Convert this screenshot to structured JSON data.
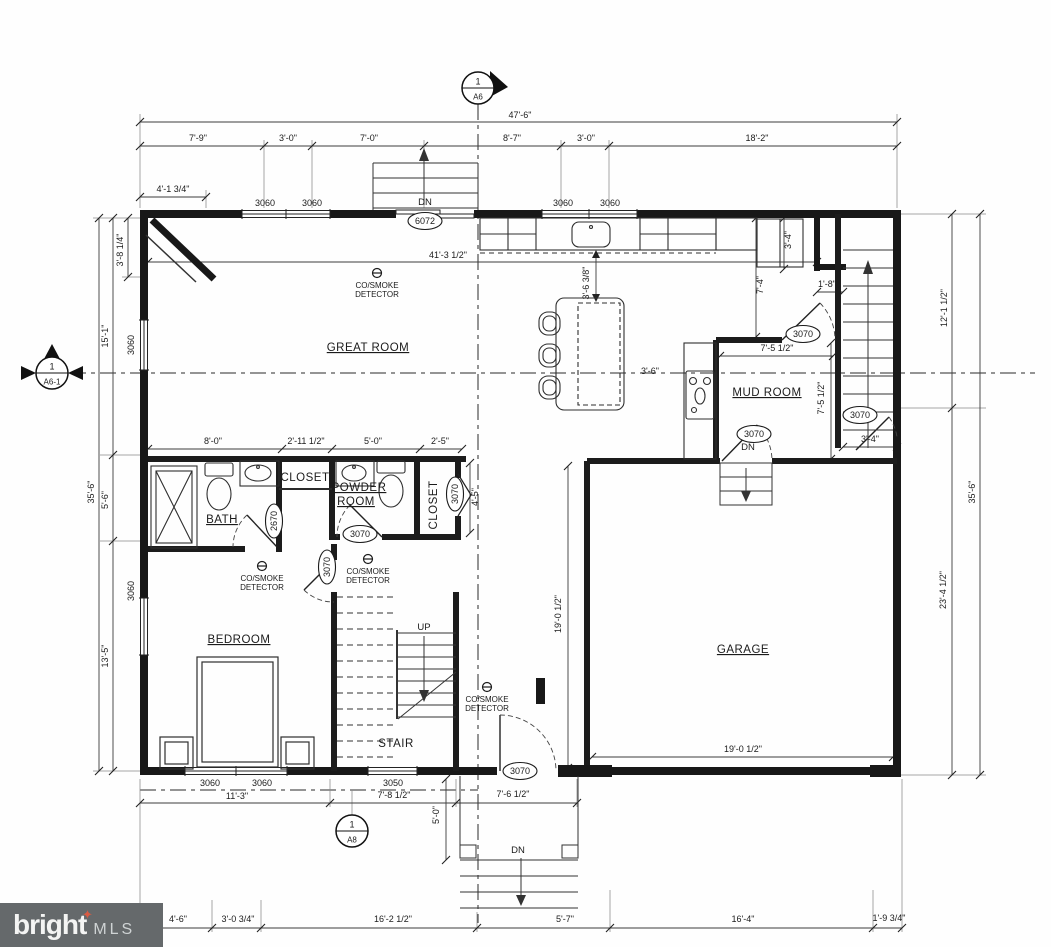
{
  "watermark": {
    "brand": "bright",
    "suffix": "MLS",
    "star": "✦",
    "bg_color": "#65696b",
    "star_color": "#d95b43"
  },
  "plan": {
    "ink_color": "#1b1b1b",
    "room_labels": [
      {
        "t": "GREAT ROOM",
        "x": 368,
        "y": 351,
        "u": true
      },
      {
        "t": "MUD ROOM",
        "x": 767,
        "y": 396,
        "u": true
      },
      {
        "t": "BATH",
        "x": 222,
        "y": 523,
        "u": true
      },
      {
        "t": "POWDER",
        "x": 359,
        "y": 491,
        "u": true
      },
      {
        "t": "ROOM",
        "x": 356,
        "y": 505,
        "u": true
      },
      {
        "t": "BEDROOM",
        "x": 239,
        "y": 643,
        "u": true
      },
      {
        "t": "STAIR",
        "x": 396,
        "y": 747
      },
      {
        "t": "GARAGE",
        "x": 743,
        "y": 653,
        "u": true
      },
      {
        "t": "CLOSET",
        "x": 305,
        "y": 481
      },
      {
        "t": "CLOSET",
        "x": 437,
        "y": 505,
        "r": true
      }
    ],
    "dim_labels": [
      {
        "t": "47'-6\"",
        "x": 520,
        "y": 118
      },
      {
        "t": "7'-9\"",
        "x": 198,
        "y": 141
      },
      {
        "t": "3'-0\"",
        "x": 288,
        "y": 141
      },
      {
        "t": "7'-0\"",
        "x": 369,
        "y": 141
      },
      {
        "t": "8'-7\"",
        "x": 512,
        "y": 141
      },
      {
        "t": "3'-0\"",
        "x": 586,
        "y": 141
      },
      {
        "t": "18'-2\"",
        "x": 757,
        "y": 141
      },
      {
        "t": "4'-1 3/4\"",
        "x": 173,
        "y": 192
      },
      {
        "t": "3'-8 1/4\"",
        "x": 123,
        "y": 250,
        "r": true
      },
      {
        "t": "15'-1\"",
        "x": 108,
        "y": 336,
        "r": true
      },
      {
        "t": "5'-6\"",
        "x": 108,
        "y": 500,
        "r": true
      },
      {
        "t": "13'-5\"",
        "x": 108,
        "y": 656,
        "r": true
      },
      {
        "t": "35'-6\"",
        "x": 94,
        "y": 492,
        "r": true
      },
      {
        "t": "12'-1 1/2\"",
        "x": 947,
        "y": 308,
        "r": true
      },
      {
        "t": "23'-4 1/2\"",
        "x": 946,
        "y": 590,
        "r": true
      },
      {
        "t": "35'-6\"",
        "x": 975,
        "y": 492,
        "r": true
      },
      {
        "t": "41'-3 1/2\"",
        "x": 448,
        "y": 258
      },
      {
        "t": "3'-6 3/8\"",
        "x": 589,
        "y": 283,
        "r": true
      },
      {
        "t": "7'-4\"",
        "x": 763,
        "y": 285,
        "r": true
      },
      {
        "t": "3'-4\"",
        "x": 791,
        "y": 240,
        "r": true
      },
      {
        "t": "1'-8\"",
        "x": 827,
        "y": 287
      },
      {
        "t": "7'-5 1/2\"",
        "x": 777,
        "y": 351
      },
      {
        "t": "7'-5 1/2\"",
        "x": 824,
        "y": 398,
        "r": true
      },
      {
        "t": "3'-4\"",
        "x": 870,
        "y": 442
      },
      {
        "t": "3'-6\"",
        "x": 650,
        "y": 374
      },
      {
        "t": "8'-0\"",
        "x": 213,
        "y": 444
      },
      {
        "t": "2'-11 1/2\"",
        "x": 306,
        "y": 444
      },
      {
        "t": "5'-0\"",
        "x": 373,
        "y": 444
      },
      {
        "t": "2'-5\"",
        "x": 440,
        "y": 444
      },
      {
        "t": "4'-5\"",
        "x": 478,
        "y": 497,
        "r": true
      },
      {
        "t": "19'-0 1/2\"",
        "x": 561,
        "y": 614,
        "r": true
      },
      {
        "t": "19'-0 1/2\"",
        "x": 743,
        "y": 752
      },
      {
        "t": "11'-3\"",
        "x": 237,
        "y": 799
      },
      {
        "t": "7'-8 1/2\"",
        "x": 394,
        "y": 798
      },
      {
        "t": "7'-6 1/2\"",
        "x": 513,
        "y": 797
      },
      {
        "t": "5'-0\"",
        "x": 439,
        "y": 815,
        "r": true
      },
      {
        "t": "4'-6\"",
        "x": 178,
        "y": 922
      },
      {
        "t": "3'-0 3/4\"",
        "x": 238,
        "y": 922
      },
      {
        "t": "16'-2 1/2\"",
        "x": 393,
        "y": 922
      },
      {
        "t": "5'-7\"",
        "x": 565,
        "y": 922
      },
      {
        "t": "16'-4\"",
        "x": 743,
        "y": 922
      },
      {
        "t": "1'-9 3/4\"",
        "x": 889,
        "y": 921
      }
    ],
    "tag_labels": [
      {
        "t": "6072",
        "x": 425,
        "y": 224
      },
      {
        "t": "3070",
        "x": 803,
        "y": 337
      },
      {
        "t": "3070",
        "x": 860,
        "y": 418
      },
      {
        "t": "3070",
        "x": 754,
        "y": 437
      },
      {
        "t": "2670",
        "x": 277,
        "y": 521,
        "r": true
      },
      {
        "t": "3070",
        "x": 360,
        "y": 537
      },
      {
        "t": "3070",
        "x": 458,
        "y": 494,
        "r": true
      },
      {
        "t": "3070",
        "x": 330,
        "y": 567,
        "r": true
      },
      {
        "t": "3070",
        "x": 520,
        "y": 774
      }
    ],
    "window_labels": [
      {
        "t": "3060",
        "x": 265,
        "y": 206
      },
      {
        "t": "3060",
        "x": 312,
        "y": 206
      },
      {
        "t": "3060",
        "x": 563,
        "y": 206
      },
      {
        "t": "3060",
        "x": 610,
        "y": 206
      },
      {
        "t": "3060",
        "x": 134,
        "y": 345,
        "r": true
      },
      {
        "t": "3060",
        "x": 134,
        "y": 591,
        "r": true
      },
      {
        "t": "3060",
        "x": 210,
        "y": 786
      },
      {
        "t": "3060",
        "x": 262,
        "y": 786
      },
      {
        "t": "3050",
        "x": 393,
        "y": 786
      }
    ],
    "flow_labels": [
      {
        "t": "DN",
        "x": 425,
        "y": 205
      },
      {
        "t": "DN",
        "x": 748,
        "y": 450
      },
      {
        "t": "DN",
        "x": 518,
        "y": 853
      },
      {
        "t": "UP",
        "x": 424,
        "y": 630
      }
    ],
    "detector": {
      "line1": "CO/SMOKE",
      "line2": "DETECTOR",
      "positions": [
        {
          "x": 377,
          "y": 273
        },
        {
          "x": 262,
          "y": 566
        },
        {
          "x": 368,
          "y": 559
        },
        {
          "x": 487,
          "y": 687
        }
      ]
    },
    "section_markers": [
      {
        "num": "1",
        "sheet": "A6",
        "x": 478,
        "y": 88,
        "f": "right"
      },
      {
        "num": "1",
        "sheet": "A6-1",
        "x": 52,
        "y": 373,
        "f": "lrt"
      },
      {
        "num": "1",
        "sheet": "A8",
        "x": 352,
        "y": 831,
        "f": "plain"
      }
    ]
  }
}
